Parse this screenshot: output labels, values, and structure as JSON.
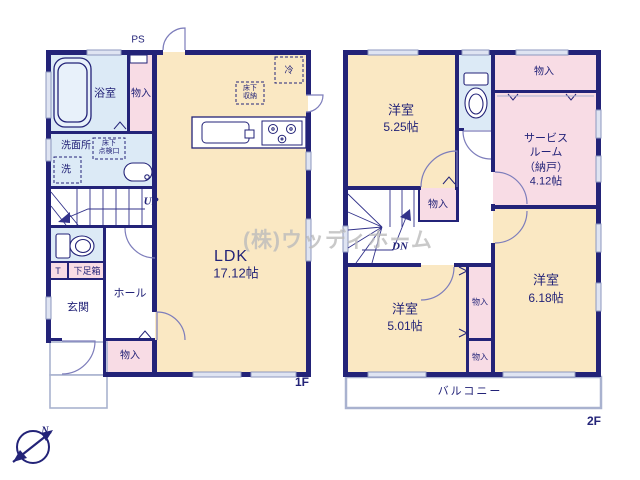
{
  "watermark": "(株)ウッディホーム",
  "compass_north": "N",
  "colors": {
    "wall": "#232378",
    "room_cream": "#fae8c3",
    "storage_pink": "#f8dce5",
    "wet_blue": "#dceaf6",
    "line_light": "#7d7dbb",
    "outline_gray": "#a9b2cf",
    "watermark_gray": "#bcbcbc"
  },
  "floor1": {
    "label": "1F",
    "ps": "PS",
    "up": "UP",
    "bathroom": "浴室",
    "storage_top": "物入",
    "washroom": "洗面所",
    "underfloor_hatch": "床下\n点検口",
    "washer": "洗",
    "ldk_name": "LDK",
    "ldk_size": "17.12帖",
    "underfloor_storage": "床下\n収納",
    "fridge": "冷",
    "toilet_t": "T",
    "shoe_box": "下足箱",
    "hall": "ホール",
    "entrance": "玄関",
    "storage_bottom": "物入"
  },
  "floor2": {
    "label": "2F",
    "dn": "DN",
    "bedroom1_name": "洋室",
    "bedroom1_size": "5.25帖",
    "storage_top_right": "物入",
    "service_room": "サービス\nルーム\n（納戸）\n4.12帖",
    "storage_stairs": "物入",
    "bedroom2_name": "洋室",
    "bedroom2_size": "5.01帖",
    "storage_mid": "物入",
    "storage_low": "物入",
    "bedroom3_name": "洋室",
    "bedroom3_size": "6.18帖",
    "balcony": "バルコニー"
  }
}
